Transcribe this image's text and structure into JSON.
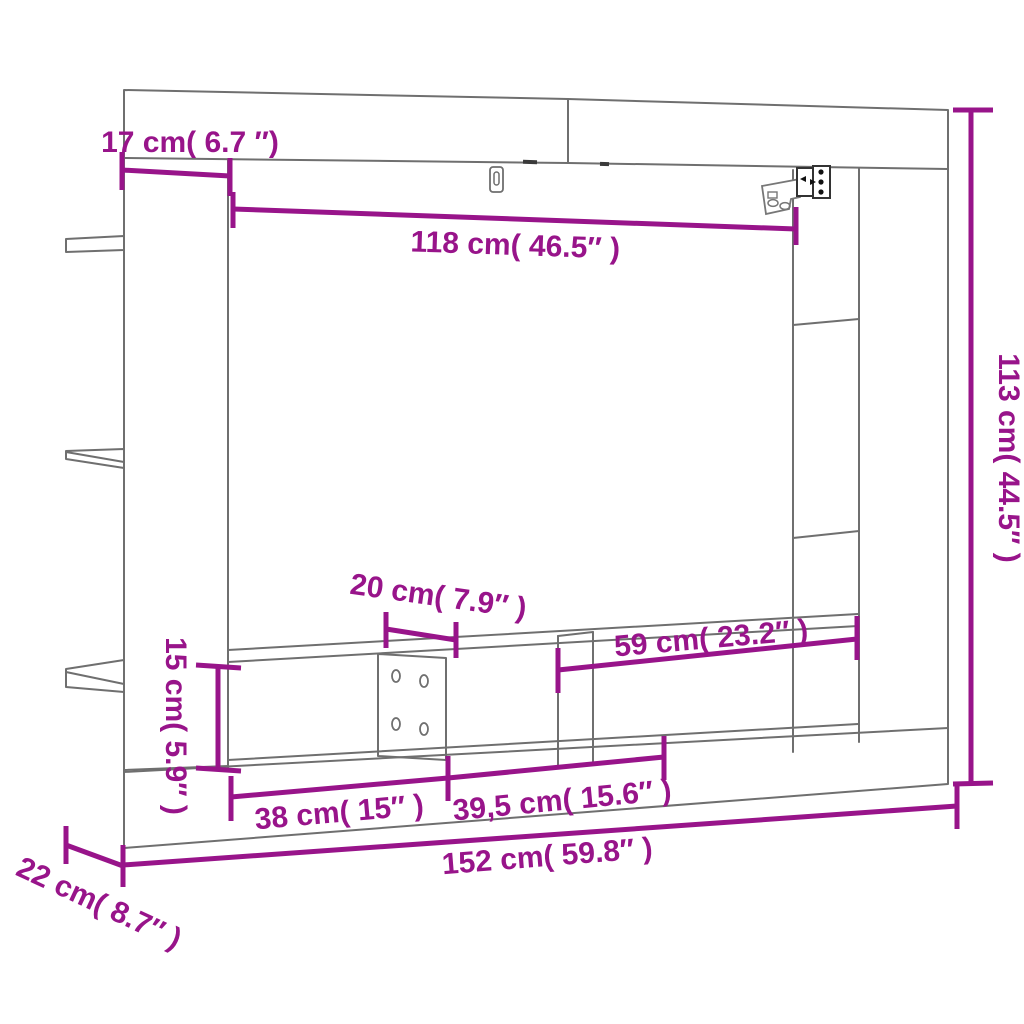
{
  "diagram": {
    "kind": "furniture-dimension-diagram",
    "subject": "wall-mounted TV cabinet line drawing with dimension callouts",
    "accent_color": "#98148A",
    "outline_color": "#6f6f6f",
    "background_color": "#ffffff",
    "dimensions": [
      {
        "id": "left-panel-width",
        "label": "17 cm( 6.7 ″)",
        "cm": 17,
        "inches": 6.7
      },
      {
        "id": "inner-opening-width",
        "label": "118 cm( 46.5″ )",
        "cm": 118,
        "inches": 46.5
      },
      {
        "id": "total-height",
        "label": "113 cm( 44.5″ )",
        "cm": 113,
        "inches": 44.5
      },
      {
        "id": "tv-support-panel-width",
        "label": "20 cm( 7.9″ )",
        "cm": 20,
        "inches": 7.9
      },
      {
        "id": "right-compartment-width",
        "label": "59 cm( 23.2″ )",
        "cm": 59,
        "inches": 23.2
      },
      {
        "id": "bench-height",
        "label": "15 cm( 5.9″ )",
        "cm": 15,
        "inches": 5.9
      },
      {
        "id": "left-compartment-width",
        "label": "38 cm( 15″ )",
        "cm": 38,
        "inches": 15
      },
      {
        "id": "middle-compartment-width",
        "label": "39,5 cm( 15.6″ )",
        "cm": 39.5,
        "inches": 15.6
      },
      {
        "id": "total-width",
        "label": "152 cm( 59.8″ )",
        "cm": 152,
        "inches": 59.8
      },
      {
        "id": "depth",
        "label": "22 cm( 8.7″ )",
        "cm": 22,
        "inches": 8.7
      }
    ]
  }
}
